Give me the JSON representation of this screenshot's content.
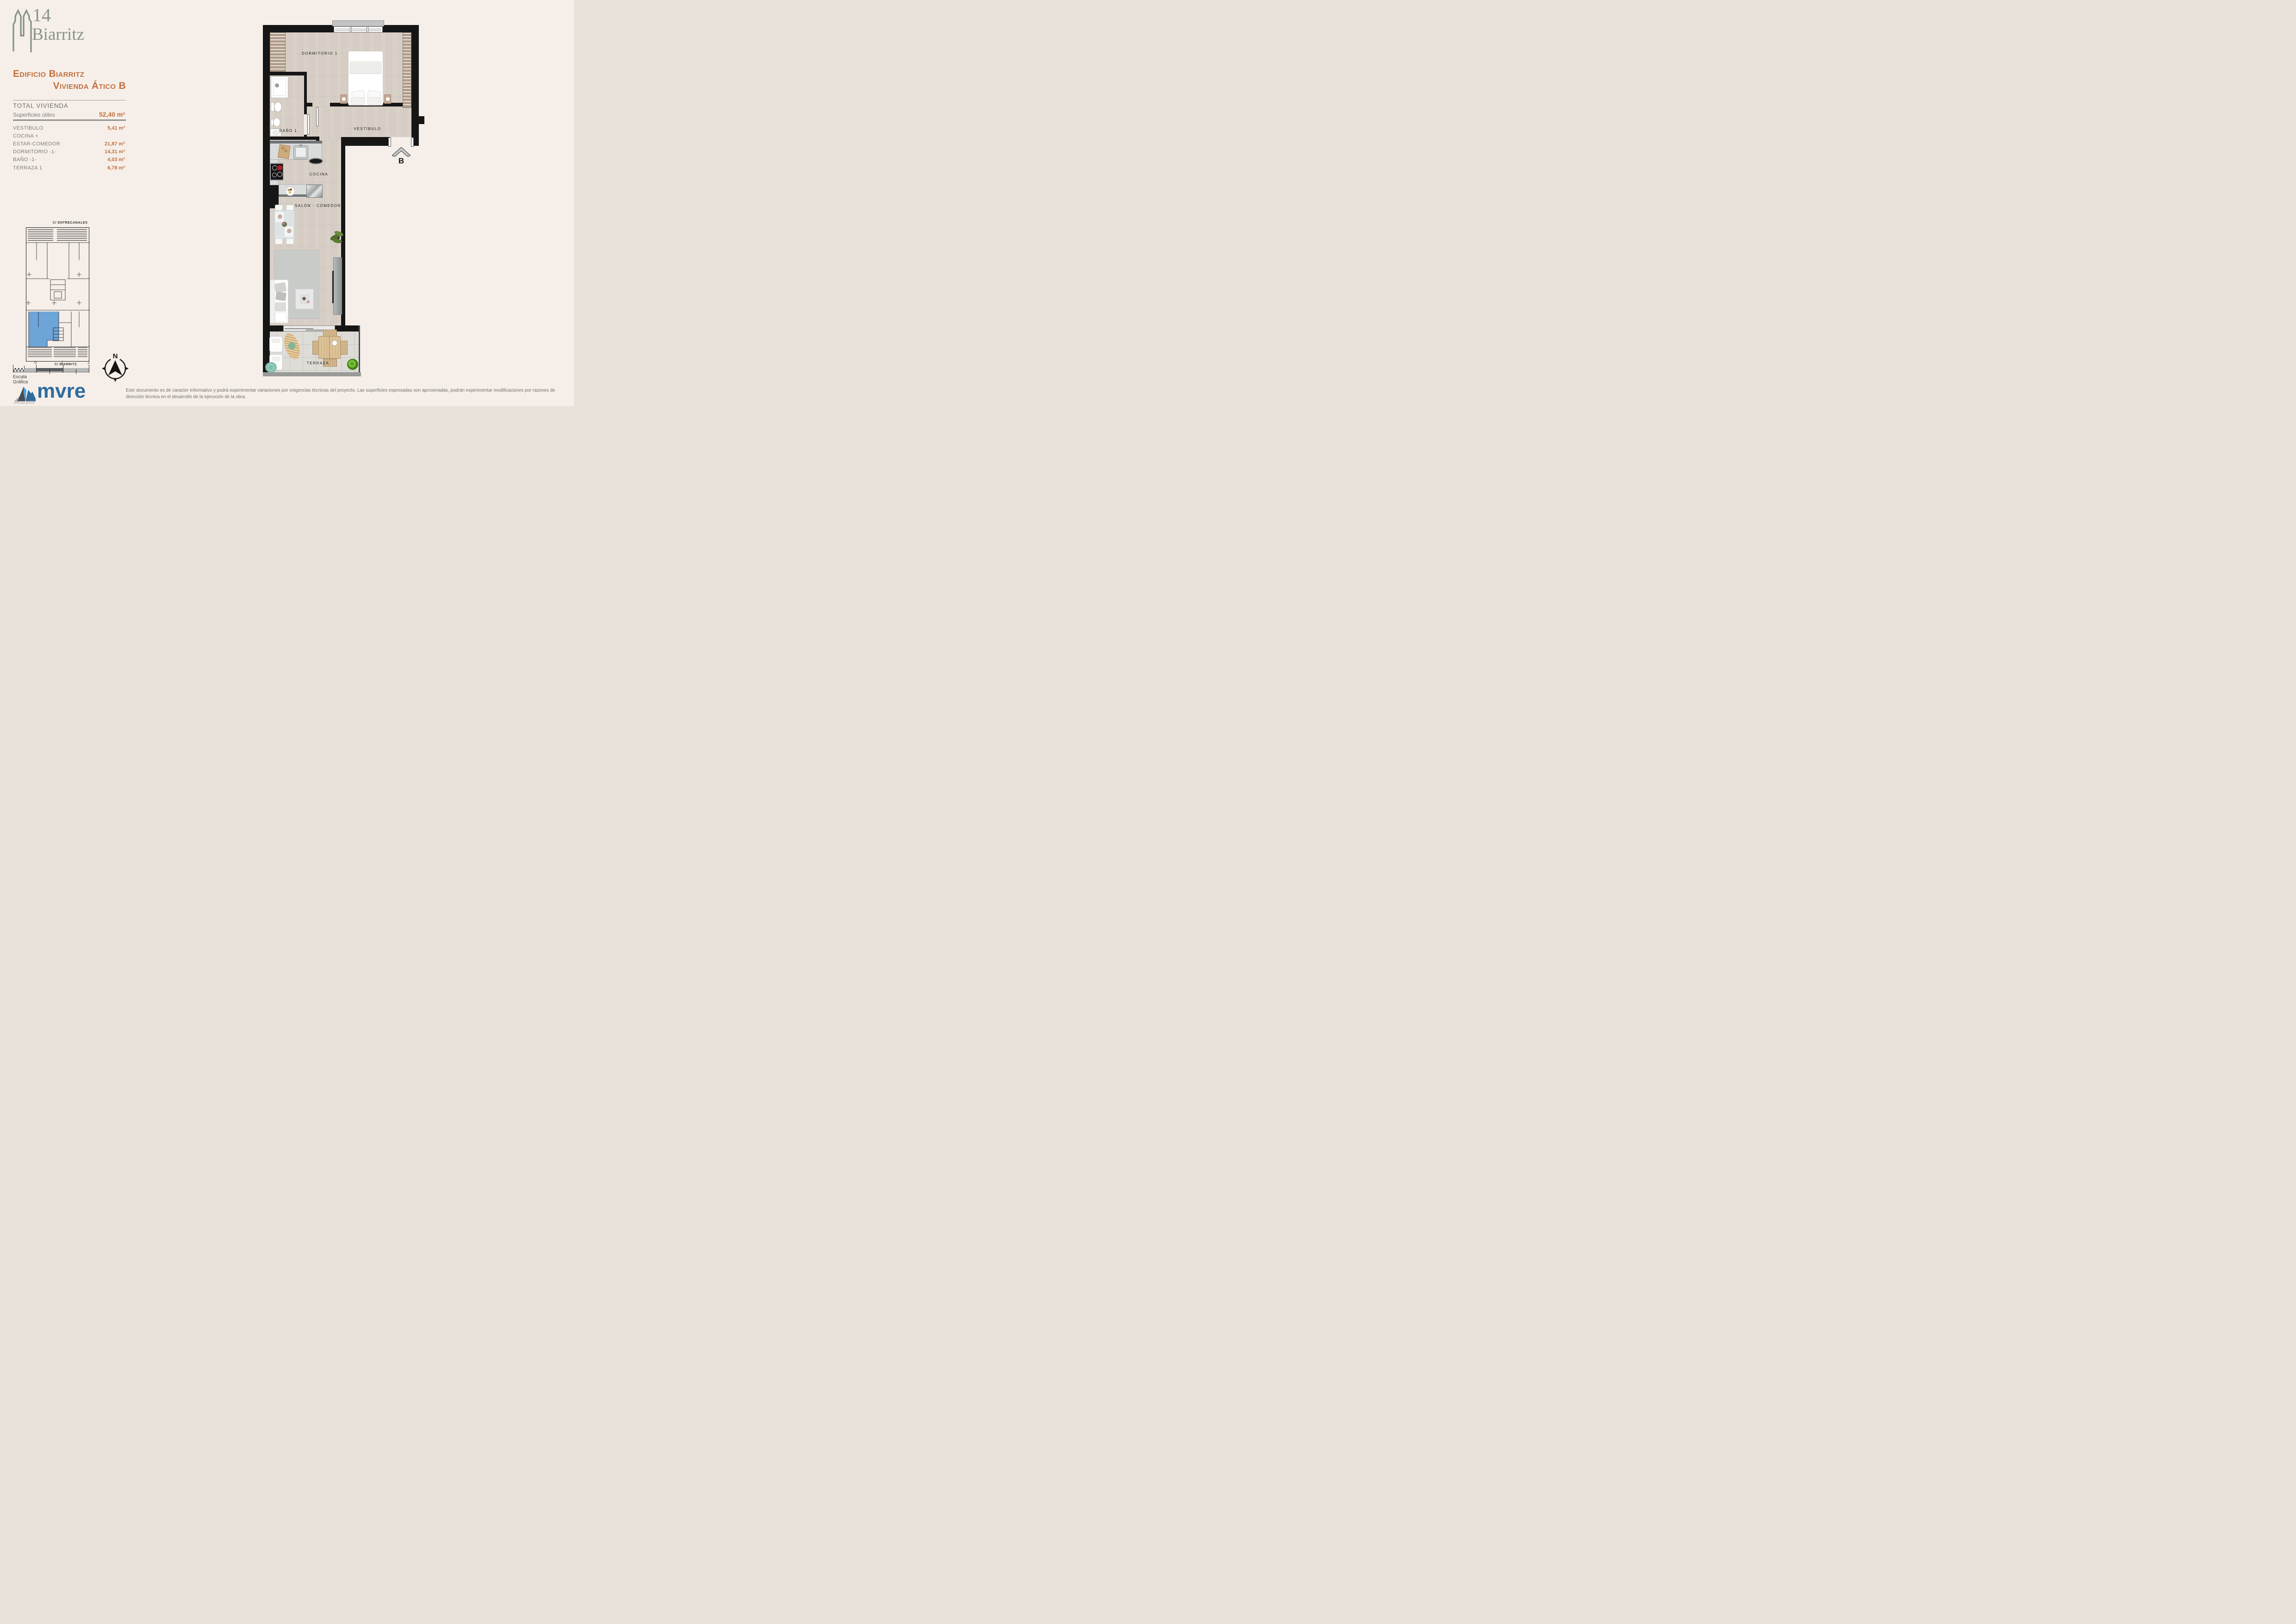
{
  "brand": {
    "number": "14",
    "name": "Biarritz",
    "logo_color": "#8a9486"
  },
  "header": {
    "line1": "Edificio Biarritz",
    "line2": "Vivienda Ático B",
    "accent_color": "#c2703e"
  },
  "summary": {
    "title": "TOTAL VIVIENDA",
    "subtitle": "Superficies útiles",
    "total_value": "52,40 m²"
  },
  "rooms": [
    {
      "label": "VESTÍBULO",
      "value": "5,41 m²"
    },
    {
      "label": "COCINA +",
      "value": ""
    },
    {
      "label": "ESTAR-COMEDOR",
      "value": "21,87 m²"
    },
    {
      "label": "DORMITORIO -1-",
      "value": "14,31 m²"
    },
    {
      "label": "BAÑO -1-",
      "value": "4,03 m²"
    },
    {
      "label": "TERRAZA 1",
      "value": "6,78 m²"
    }
  ],
  "plan": {
    "rooms": {
      "dormitorio": "DORMITORIO 1",
      "bano": "BAÑO 1",
      "vestibulo": "VESTÍBULO",
      "cocina": "COCINA",
      "salon": "SALÓN - COMEDOR",
      "terraza": "TERRAZA"
    },
    "unit_marker": "B"
  },
  "keyplan": {
    "street_top": "C/ ENTRECANALES",
    "street_bottom": "C/ BIARRITZ",
    "highlight_color": "#6ea5d8"
  },
  "scalebar": {
    "labels": [
      "0",
      "1",
      "2"
    ],
    "caption": "Escala Gráfica"
  },
  "compass": {
    "label": "N"
  },
  "footer": {
    "logo_text": "mvre",
    "date": "24/11/2025",
    "disclaimer": "Este documento es de caracter informativo y podrá experimentar variaciones por exigencias técnicas del proyecto. Las superficies expresadas son aproximadas, podrán experimentar modificaciones por razones de dirección técnica en el desarrollo de la ejecución de la obra."
  }
}
